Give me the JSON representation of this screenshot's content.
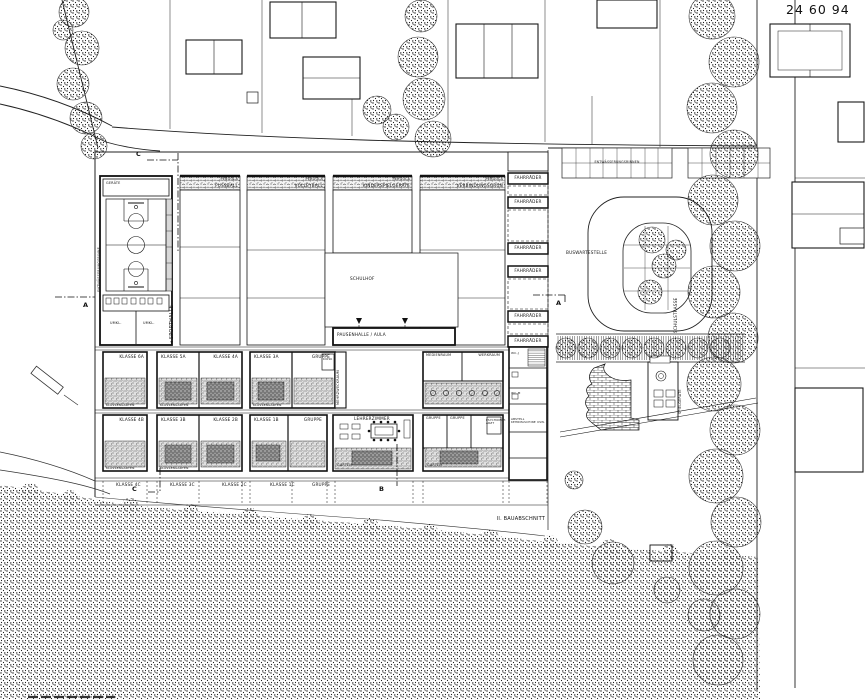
{
  "sheet_number": "24 60 94",
  "sporthalle": {
    "name": "SPORTHALLE",
    "arrow": "◄",
    "geraete": "GERÄTE",
    "umkl": "UMKL.",
    "drain": "ENTWÄSSERUNGSRINNE"
  },
  "fields": {
    "pergola": "PERGOLA",
    "fussball": "FUSSBALL",
    "volleyball": "VOLLEYBALL",
    "spielgeraete": "KINDERSPIELGERÄTE",
    "verbindung": "VERBINDUNGSGRÜN"
  },
  "courtyard": {
    "schulhof": "SCHULHOF",
    "aula": "PAUSENHALLE / AULA"
  },
  "rooms": {
    "lehrerzimmer": "LEHRERZIMMER",
    "medienraum": "MEDIENRAUM",
    "werkraum": "WERKRAUM",
    "gruppe": "GRUPPE",
    "arzt": "PSYCHOMOT. ARZT",
    "mehrzweck": "MEHRZWECKRAUM",
    "kiosk": "KIOSK",
    "garten": "GARTEN",
    "klassengarten": "KLASSENGARTEN",
    "wcj": "WC-J",
    "wcm": "WC-M",
    "abstell": "ABSTELL KEHRMASCHINE USW."
  },
  "classes": {
    "a": [
      "KLASSE 6A",
      "KLASSE 5A",
      "KLASSE 4A",
      "KLASSE 3A",
      "GRUPPE"
    ],
    "b": [
      "KLASSE 4B",
      "KLASSE 3B",
      "KLASSE 2B",
      "KLASSE 1B",
      "GRUPPE"
    ],
    "c": [
      "KLASSE 4C",
      "KLASSE 3C",
      "KLASSE 2C",
      "KLASSE 1C",
      "GRUPPE"
    ]
  },
  "site": {
    "fahrraeder": "FAHRRÄDER",
    "entwaesserung": "ENTWÄSSERUNGSRINNEN",
    "bus": "BUSWARTESTELLE",
    "strasse": "SCHULSTRASSE",
    "spiel": "SPIELGERÄTE",
    "phase": "II. BAUABSCHNITT"
  },
  "sections": {
    "a": "A",
    "b": "B",
    "c": "C"
  },
  "colors": {
    "ink": "#1a1a1a",
    "paper": "#ffffff",
    "garden_grey": "#e0e0e0",
    "bed_grey": "#9a9a9a"
  }
}
